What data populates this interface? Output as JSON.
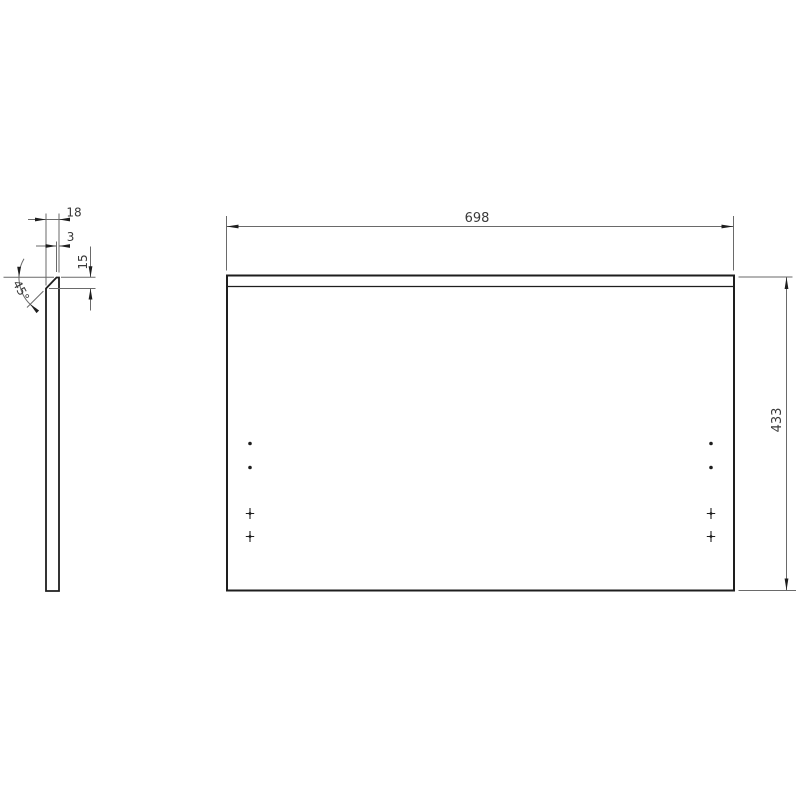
{
  "drawing_type": "technical-panel-drawing",
  "colors": {
    "background": "#ffffff",
    "outline": "#1e1e1e",
    "dim_line": "#6a6a6a",
    "text": "#3a3a3a"
  },
  "dimensions": {
    "front_width": "698",
    "front_height": "433",
    "thickness": "18",
    "top_flat": "3",
    "chamfer_depth": "15",
    "chamfer_angle": "45°"
  },
  "front_view": {
    "hole_marks": [
      {
        "type": "dot",
        "x": 250,
        "y": 443.5
      },
      {
        "type": "dot",
        "x": 250,
        "y": 467.5
      },
      {
        "type": "cross",
        "x": 250,
        "y": 513.5
      },
      {
        "type": "cross",
        "x": 250,
        "y": 536.5
      },
      {
        "type": "dot",
        "x": 711,
        "y": 443.5
      },
      {
        "type": "dot",
        "x": 711,
        "y": 467.5
      },
      {
        "type": "cross",
        "x": 711,
        "y": 513.5
      },
      {
        "type": "cross",
        "x": 711,
        "y": 536.5
      }
    ]
  }
}
